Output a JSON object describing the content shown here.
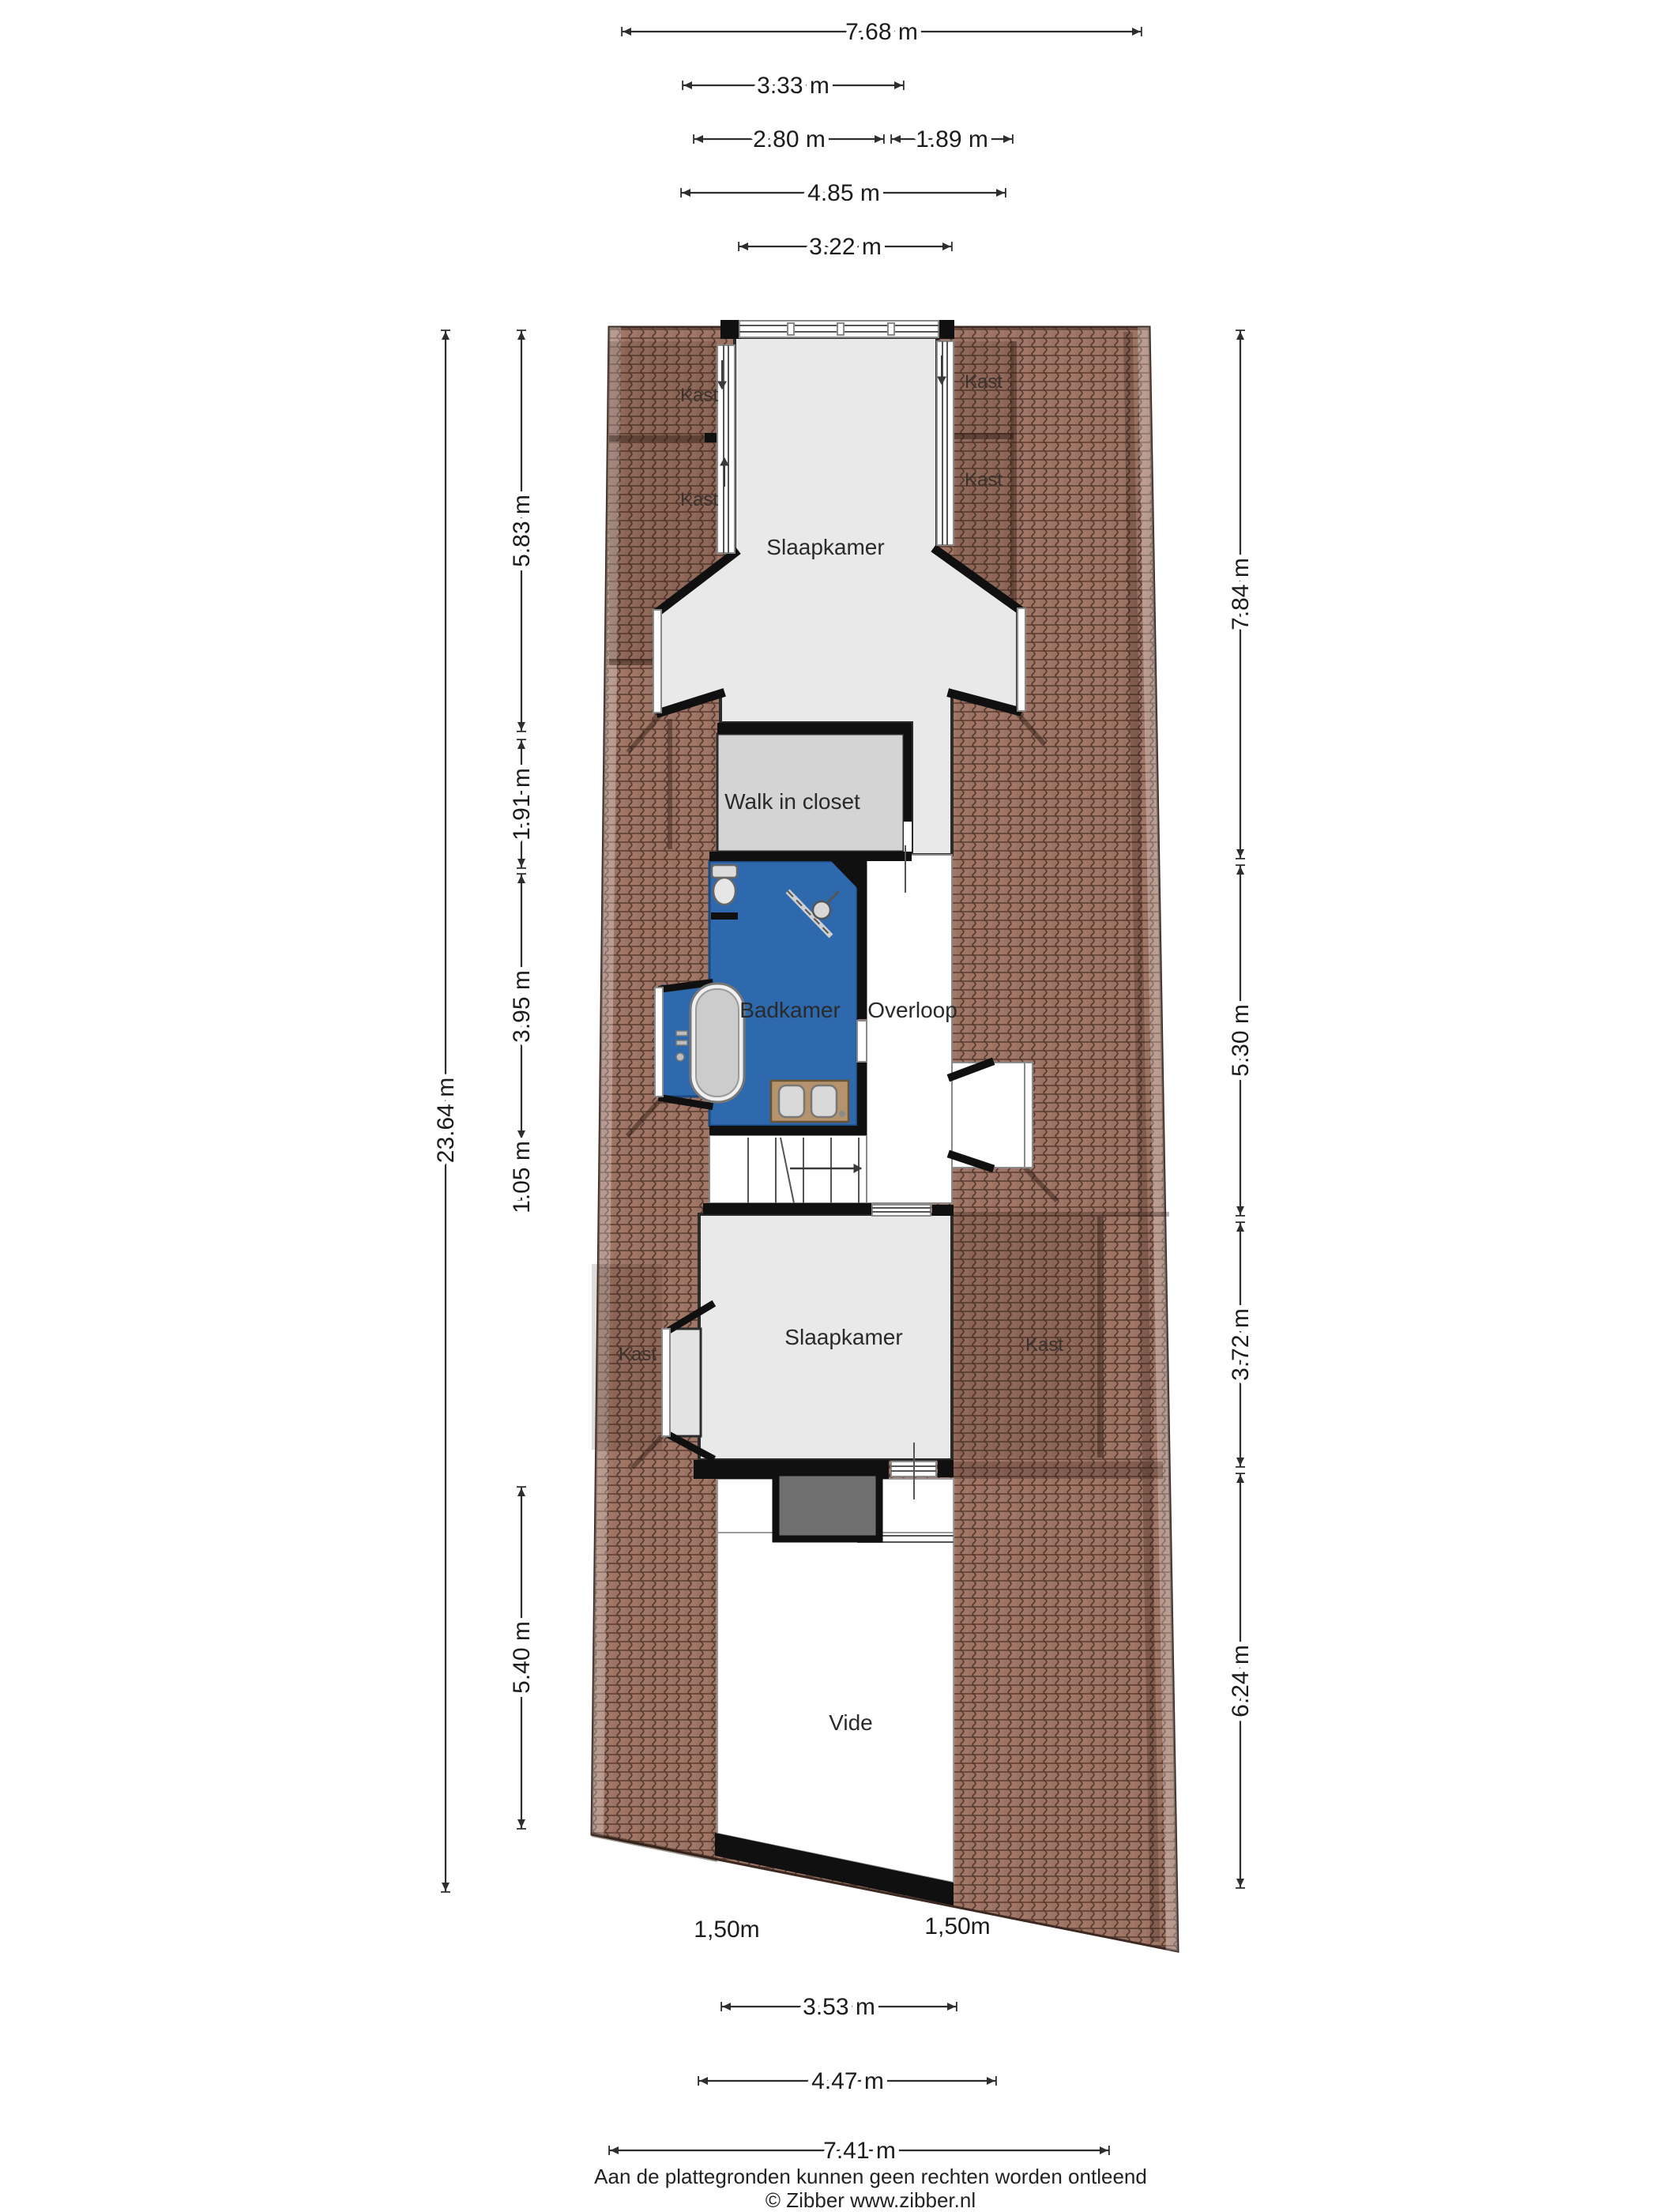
{
  "rooms": {
    "slaapkamer_top": {
      "label": "Slaapkamer"
    },
    "walk_in_closet": {
      "label": "Walk in closet"
    },
    "badkamer": {
      "label": "Badkamer"
    },
    "overloop": {
      "label": "Overloop"
    },
    "slaapkamer_mid": {
      "label": "Slaapkamer"
    },
    "vide": {
      "label": "Vide"
    },
    "kast_labels": [
      {
        "label": "Kast"
      },
      {
        "label": "Kast"
      },
      {
        "label": "Kast"
      },
      {
        "label": "Kast"
      },
      {
        "label": "Kast"
      },
      {
        "label": "Kast"
      }
    ]
  },
  "dims": {
    "top": [
      {
        "label": "7.68 m"
      },
      {
        "label": "3.33 m"
      },
      {
        "label": "2.80 m"
      },
      {
        "label": "1.89 m"
      },
      {
        "label": "4.85 m"
      },
      {
        "label": "3.22 m"
      }
    ],
    "left_outer": {
      "label": "23.64 m"
    },
    "left": [
      {
        "label": "5.83 m"
      },
      {
        "label": "1.91 m"
      },
      {
        "label": "3.95 m"
      },
      {
        "label": "1.05 m"
      },
      {
        "label": "5.40 m"
      }
    ],
    "right": [
      {
        "label": "7.84 m"
      },
      {
        "label": "5.30 m"
      },
      {
        "label": "3.72 m"
      },
      {
        "label": "6.24 m"
      }
    ],
    "bottom": [
      {
        "label": "3.53 m"
      },
      {
        "label": "4.47 m"
      },
      {
        "label": "7.41 m"
      }
    ],
    "height_markers": [
      {
        "label": "1,50m"
      },
      {
        "label": "1,50m"
      }
    ]
  },
  "footer": {
    "line1": "Aan de plattegronden kunnen geen rechten worden ontleend",
    "line2": "© Zibber www.zibber.nl"
  },
  "colors": {
    "roof_tile": "#9c7263",
    "roof_tile_line": "#53392f",
    "floor_light": "#e9e9e9",
    "floor_closet": "#d4d4d4",
    "bathroom_blue": "#2e68ad",
    "wall_black": "#111111",
    "vanity_wood": "#b5946d",
    "block_gray": "#6f6f6f"
  }
}
